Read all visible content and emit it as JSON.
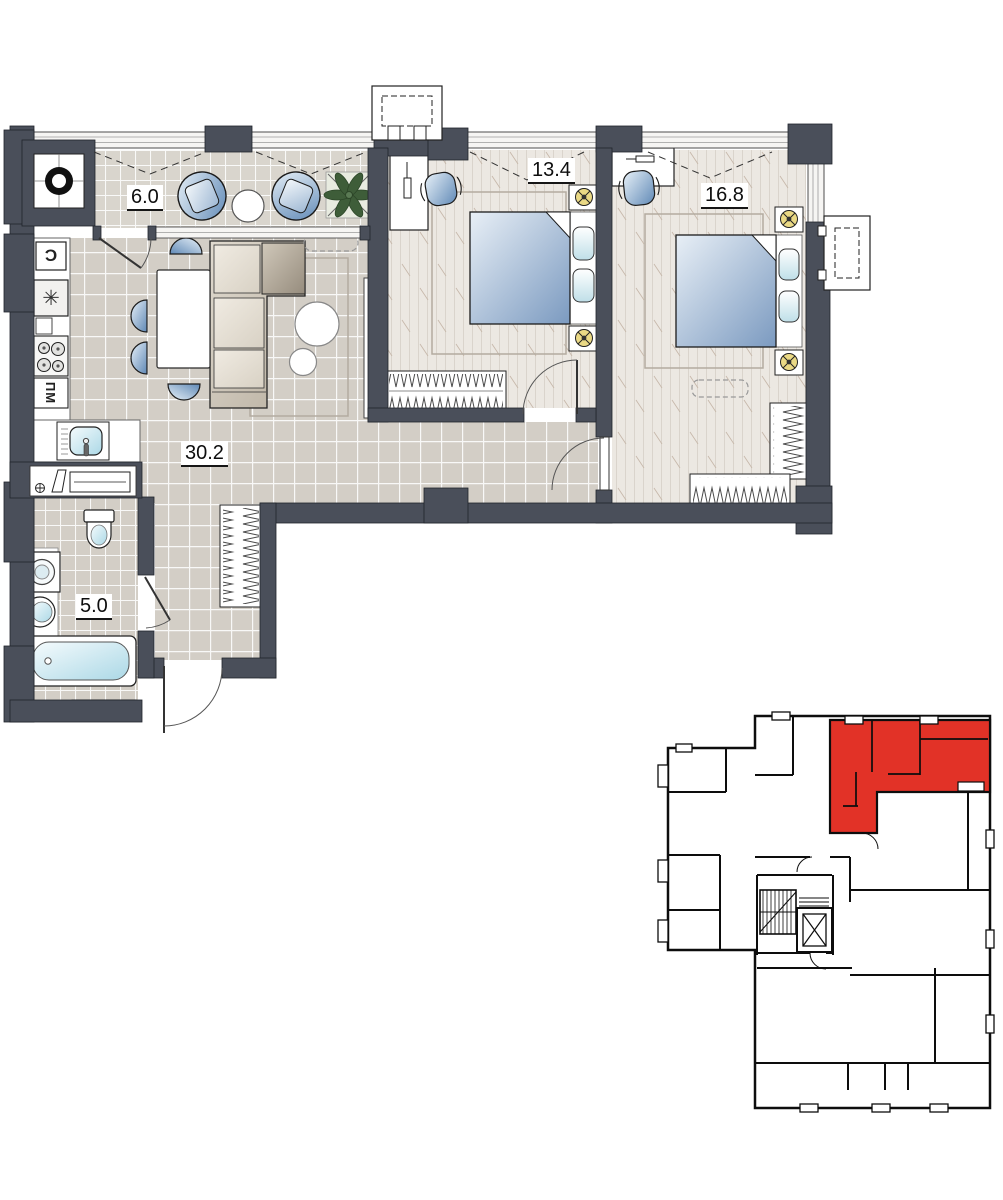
{
  "document": {
    "kind": "apartment-floor-plan-with-building-locator"
  },
  "rooms": {
    "balcony": {
      "name": "balcony",
      "area": "6.0"
    },
    "living_kitchen": {
      "name": "living-kitchen",
      "area": "30.2"
    },
    "bedroom_1": {
      "name": "bedroom-1",
      "area": "13.4"
    },
    "bedroom_2": {
      "name": "bedroom-2",
      "area": "16.8"
    },
    "bathroom": {
      "name": "bathroom",
      "area": "5.0"
    }
  },
  "kitchen": {
    "dishwasher_label": "ПМ",
    "fridge_symbol": "Ɔ",
    "freezer_symbol": "✳"
  },
  "colors": {
    "wall": "#4a4f5a",
    "floor_tile": "#d3cec6",
    "floor_tile_balcony": "#d9d5cd",
    "floor_wood": "#ece8e2",
    "furniture_blue": "#6089b6",
    "sofa_beige": "#c9c0b1",
    "lamp_yellow": "#ead985",
    "plant_green": "#3e5d39",
    "locator_highlight_red": "#e23227",
    "locator_line": "#0d0d0d"
  },
  "locator": {
    "highlighted_unit_color": "#e23227"
  }
}
